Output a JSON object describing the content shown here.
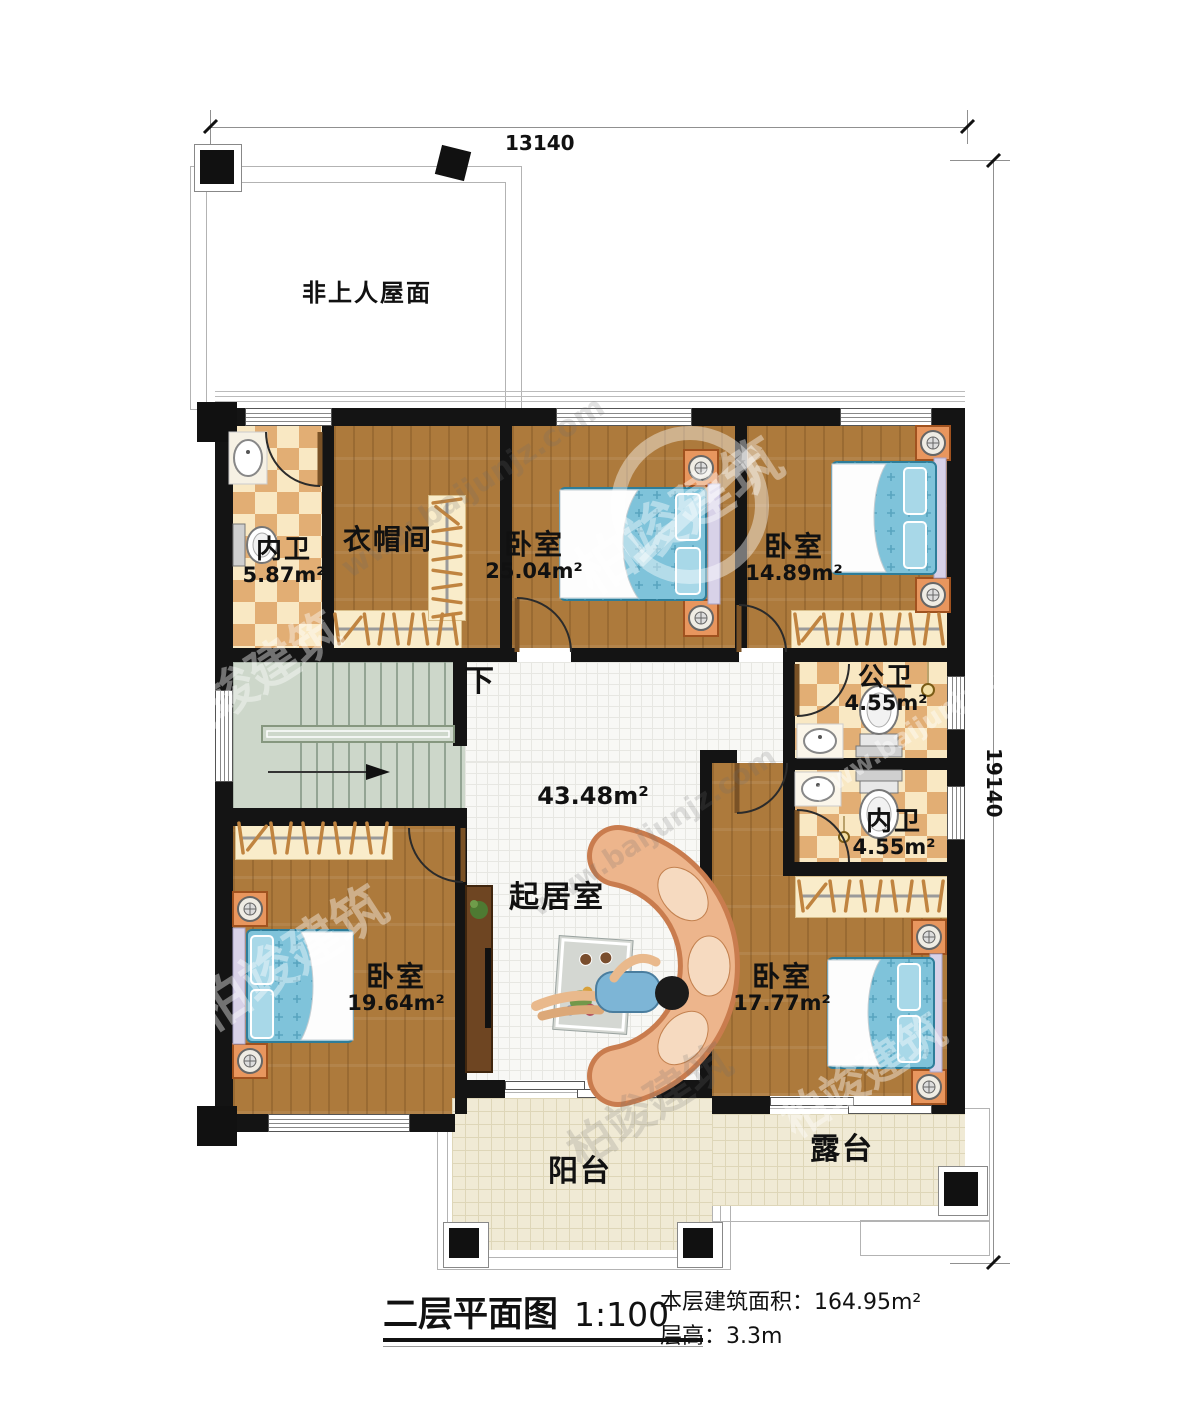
{
  "watermark": {
    "brand": "柏竣建筑",
    "url": "www.baijunjz.com"
  },
  "dimensions": {
    "top": "13140",
    "right": "19140"
  },
  "roof": {
    "label": "非上人屋面"
  },
  "stairs": {
    "down": "下"
  },
  "rooms": {
    "bath1": {
      "name": "内卫",
      "area": "5.87m²"
    },
    "cloak": {
      "name": "衣帽间"
    },
    "bed1": {
      "name": "卧室",
      "area": "25.04m²"
    },
    "bed2": {
      "name": "卧室",
      "area": "14.89m²"
    },
    "bathp": {
      "name": "公卫",
      "area": "4.55m²"
    },
    "bath2": {
      "name": "内卫",
      "area": "4.55m²"
    },
    "living": {
      "name": "起居室",
      "area": "43.48m²"
    },
    "bed3": {
      "name": "卧室",
      "area": "19.64m²"
    },
    "bed4": {
      "name": "卧室",
      "area": "17.77m²"
    },
    "balcony": {
      "name": "阳台"
    },
    "terrace": {
      "name": "露台"
    }
  },
  "title_block": {
    "title": "二层平面图",
    "scale": "1:100",
    "area_label": "本层建筑面积：",
    "area_value": "164.95m²",
    "height_label": "层高：",
    "height_value": "3.3m"
  }
}
